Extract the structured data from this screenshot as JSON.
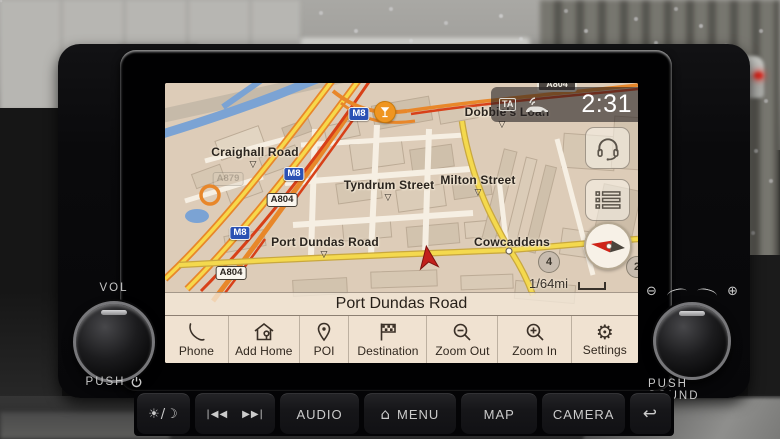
{
  "screen": {
    "status_bar": {
      "ta_badge": "TA",
      "time": "2:31",
      "clipped_road_badge": "A804"
    },
    "map": {
      "labels": {
        "craighall": "Craighall Road",
        "dobbies": "Dobbie's Loan",
        "tyndrum": "Tyndrum Street",
        "milton": "Milton Street",
        "port_dundas": "Port Dundas Road",
        "cowcaddens": "Cowcaddens"
      },
      "badges": {
        "motorway": "M8",
        "a_road": "A804",
        "faint_road": "A879"
      },
      "marker_glyph": "▽",
      "junction_circles": {
        "left": "4",
        "right": "2"
      },
      "scale_label": "1/64mi"
    },
    "street_bar": {
      "current_street": "Port Dundas Road"
    },
    "menu": {
      "gear_glyph": "⚙",
      "items": [
        {
          "label": "Phone"
        },
        {
          "label": "Add Home"
        },
        {
          "label": "POI"
        },
        {
          "label": "Destination"
        },
        {
          "label": "Zoom Out"
        },
        {
          "label": "Zoom In"
        },
        {
          "label": "Settings"
        }
      ]
    }
  },
  "hardware": {
    "left_knob": {
      "top_label": "VOL",
      "bottom_label": "PUSH"
    },
    "right_knob": {
      "bottom_label": "PUSH SOUND",
      "zoom_out_glyph": "⊖",
      "zoom_in_glyph": "⊕"
    },
    "buttons": {
      "day_night_glyph": "☀/☽",
      "seek_back_glyph": "|◀◀",
      "seek_fwd_glyph": "▶▶|",
      "audio": "AUDIO",
      "menu": "MENU",
      "menu_house_glyph": "⌂",
      "map": "MAP",
      "camera": "CAMERA",
      "back_glyph": "↩"
    }
  }
}
